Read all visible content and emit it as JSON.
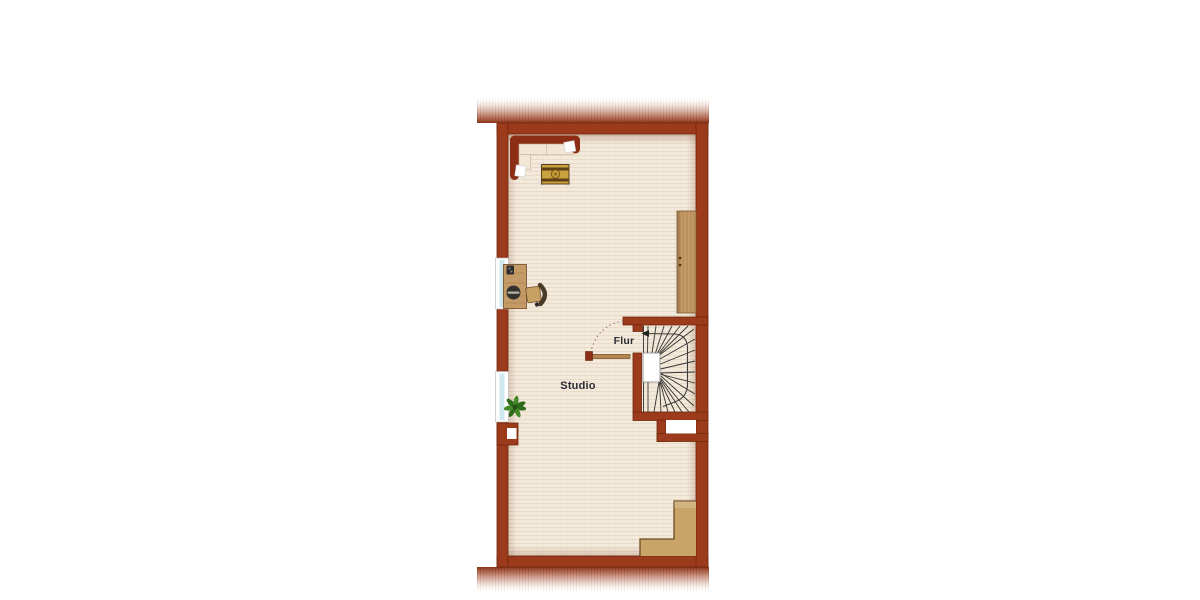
{
  "image_type": "architectural floor plan",
  "floorplan": {
    "labels": {
      "studio": "Studio",
      "flur": "Flur"
    },
    "rooms": [
      {
        "name": "Studio",
        "contents": [
          "corner-sofa",
          "coffee-table",
          "desk",
          "office-chair",
          "wardrobe",
          "potted-plant",
          "chimney-block",
          "corner-steps"
        ]
      },
      {
        "name": "Flur",
        "contents": [
          "winder-staircase",
          "door",
          "door-swing-arc",
          "direction-arrow"
        ]
      }
    ],
    "features": [
      "two-windows-left-wall",
      "roof-hatch-band-top",
      "roof-hatch-band-bottom",
      "stairwell-niche"
    ],
    "colors": {
      "wall": "#9C3A1C",
      "wall_outline": "#6F2810",
      "floor": "#F3EADB",
      "wood": "#C49A66",
      "sofa_frame": "#8C2D15",
      "cushion": "#F1E7D4",
      "pillow": "#FFFFFF",
      "table_gold": "#C9A23E",
      "table_stripe": "#5E3F16",
      "plant_green": "#2F6B1C",
      "window_glass": "#CFE9F0",
      "stair_line": "#333333",
      "label_text": "#2D2D35",
      "background": "#FFFFFF"
    }
  }
}
